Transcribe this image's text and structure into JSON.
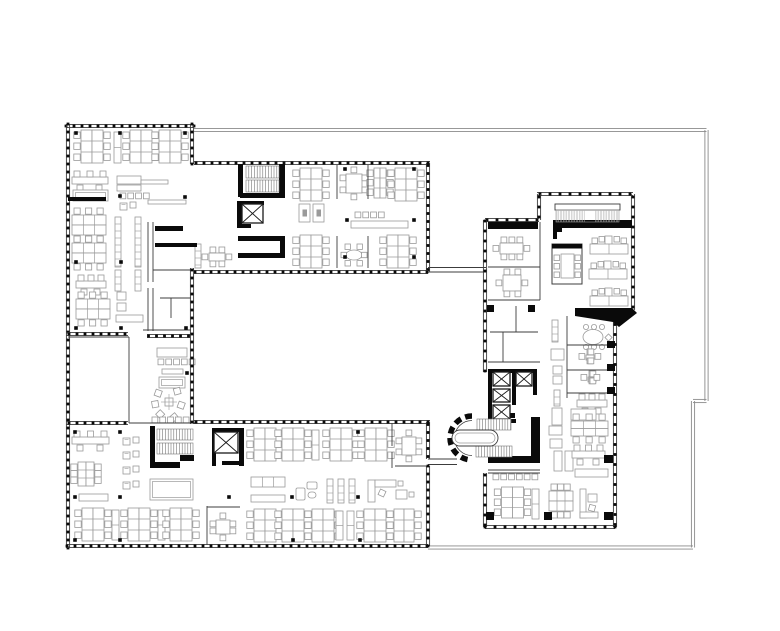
{
  "colors": {
    "bg": "#ffffff",
    "black": "#0a0a0a",
    "wall": "#1a1a1a",
    "thin": "#3c3c3c",
    "light": "#9a9a9a",
    "boundary": "#8a8a8a",
    "tread": "#6a6a6a"
  },
  "canvas": {
    "w": 780,
    "h": 631
  },
  "plan": {
    "boundary": [
      [
        194,
        130,
        706.5,
        130
      ],
      [
        706.5,
        130,
        706.5,
        401
      ],
      [
        693,
        401,
        706.5,
        401
      ],
      [
        693,
        401,
        693,
        547.5
      ],
      [
        428,
        547.5,
        693,
        547.5
      ]
    ],
    "mullion_walls": [
      [
        66,
        126,
        194,
        126
      ],
      [
        68,
        124,
        68,
        548
      ],
      [
        66,
        334,
        128,
        334
      ],
      [
        192,
        124,
        192,
        164
      ],
      [
        194,
        163,
        430,
        163
      ],
      [
        428,
        163,
        428,
        272
      ],
      [
        194,
        272,
        428,
        272
      ],
      [
        192,
        268,
        192,
        424
      ],
      [
        147,
        336,
        190,
        336
      ],
      [
        66,
        423,
        128,
        423
      ],
      [
        194,
        422,
        430,
        422
      ],
      [
        428,
        422,
        428,
        459
      ],
      [
        428,
        466,
        428,
        546
      ],
      [
        66,
        546,
        428,
        546
      ],
      [
        537,
        194,
        633,
        194,
        10
      ],
      [
        633,
        194,
        633,
        310,
        10
      ],
      [
        539,
        194,
        539,
        220,
        10
      ],
      [
        485,
        220,
        539,
        220,
        10
      ],
      [
        485,
        220,
        485,
        372,
        10
      ],
      [
        615,
        322,
        615,
        527,
        10
      ],
      [
        485,
        527,
        615,
        527,
        10
      ],
      [
        485,
        473,
        485,
        527,
        10
      ]
    ],
    "thin_walls": [
      [
        148,
        222,
        148,
        282
      ],
      [
        153,
        222,
        153,
        282
      ],
      [
        148,
        288,
        148,
        331
      ],
      [
        153,
        288,
        153,
        331
      ],
      [
        153,
        270,
        191,
        270
      ],
      [
        160,
        298,
        191,
        298
      ],
      [
        171,
        298,
        171,
        318
      ],
      [
        143,
        330,
        191,
        330
      ],
      [
        337,
        165,
        337,
        199
      ],
      [
        368,
        165,
        368,
        199
      ],
      [
        337,
        236,
        337,
        268
      ],
      [
        368,
        236,
        368,
        268
      ],
      [
        207,
        506,
        207,
        545
      ],
      [
        207,
        507,
        240,
        507
      ],
      [
        392,
        423,
        392,
        446
      ],
      [
        392,
        452,
        392,
        468
      ],
      [
        395,
        466,
        428,
        466
      ],
      [
        129,
        337,
        129,
        423
      ],
      [
        68,
        337,
        129,
        337
      ],
      [
        129,
        423,
        195,
        423
      ],
      [
        428,
        267.5,
        486,
        267.5
      ],
      [
        428,
        272,
        486,
        272
      ],
      [
        428,
        459,
        457,
        459
      ],
      [
        428,
        464.5,
        457,
        464.5
      ],
      [
        540,
        222,
        540,
        300
      ],
      [
        488,
        267,
        540,
        267
      ],
      [
        488,
        300,
        540,
        300
      ],
      [
        516,
        306,
        516,
        332
      ],
      [
        490,
        332,
        538,
        332
      ],
      [
        503,
        332,
        503,
        362
      ],
      [
        488,
        362,
        540,
        362
      ],
      [
        567,
        316,
        567,
        398
      ],
      [
        567,
        345,
        612,
        345
      ],
      [
        567,
        370,
        612,
        370
      ],
      [
        567,
        393,
        612,
        393
      ],
      [
        488,
        470,
        540,
        470
      ],
      [
        488,
        473,
        540,
        473
      ]
    ],
    "black_rects": [
      [
        68,
        197,
        38,
        4
      ],
      [
        238,
        164,
        5,
        33
      ],
      [
        279,
        164,
        6,
        33
      ],
      [
        240,
        193,
        45,
        5
      ],
      [
        237,
        201,
        5,
        27
      ],
      [
        237,
        201,
        27,
        4
      ],
      [
        259,
        207,
        4,
        12
      ],
      [
        237,
        224,
        14,
        4
      ],
      [
        238,
        236,
        46,
        5
      ],
      [
        238,
        253,
        46,
        5
      ],
      [
        280,
        236,
        5,
        22
      ],
      [
        150,
        426,
        5,
        42
      ],
      [
        150,
        462,
        30,
        6
      ],
      [
        180,
        455,
        14,
        6
      ],
      [
        212,
        428,
        4,
        38
      ],
      [
        239,
        428,
        5,
        38
      ],
      [
        212,
        428,
        31,
        4
      ],
      [
        222,
        461,
        22,
        4
      ],
      [
        488,
        222,
        50,
        7
      ],
      [
        553,
        220,
        79,
        8
      ],
      [
        553,
        228,
        9,
        4
      ],
      [
        553,
        228,
        4,
        11
      ],
      [
        488,
        369,
        4,
        53
      ],
      [
        488,
        369,
        48,
        4
      ],
      [
        512,
        372,
        4,
        33
      ],
      [
        533,
        369,
        4,
        26
      ],
      [
        488,
        419,
        28,
        4
      ],
      [
        499,
        413,
        16,
        5
      ],
      [
        488,
        456,
        52,
        7
      ],
      [
        531,
        417,
        9,
        46
      ],
      [
        487,
        305,
        7,
        7
      ],
      [
        528,
        305,
        7,
        7
      ],
      [
        607,
        341,
        8,
        7
      ],
      [
        607,
        364,
        8,
        7
      ],
      [
        607,
        387,
        8,
        7
      ],
      [
        604,
        455,
        9,
        8
      ],
      [
        604,
        512,
        9,
        8
      ],
      [
        544,
        512,
        8,
        8
      ],
      [
        486,
        512,
        8,
        8
      ],
      [
        155,
        226,
        28,
        5
      ],
      [
        155,
        243,
        42,
        4
      ]
    ],
    "black_polys": [
      [
        [
          575,
          308
        ],
        [
          632,
          308
        ],
        [
          637,
          313
        ],
        [
          619,
          327
        ],
        [
          613,
          322
        ],
        [
          575,
          316
        ]
      ]
    ],
    "columns": [
      [
        76,
        133
      ],
      [
        120,
        133
      ],
      [
        185,
        133
      ],
      [
        120,
        196
      ],
      [
        185,
        197
      ],
      [
        76,
        262
      ],
      [
        121,
        262
      ],
      [
        76,
        328
      ],
      [
        121,
        328
      ],
      [
        186,
        328
      ],
      [
        187,
        373
      ],
      [
        345,
        169
      ],
      [
        414,
        169
      ],
      [
        347,
        220
      ],
      [
        414,
        220
      ],
      [
        345,
        257
      ],
      [
        414,
        257
      ],
      [
        75,
        432
      ],
      [
        120,
        432
      ],
      [
        358,
        432
      ],
      [
        75,
        497
      ],
      [
        120,
        497
      ],
      [
        229,
        497
      ],
      [
        292,
        497
      ],
      [
        358,
        497
      ],
      [
        75,
        540
      ],
      [
        120,
        540
      ],
      [
        293,
        540
      ],
      [
        360,
        540
      ]
    ],
    "elevators": [
      [
        242,
        204,
        21,
        19
      ],
      [
        214,
        432,
        24,
        21
      ],
      [
        493,
        372,
        17,
        14
      ],
      [
        516,
        372,
        16,
        14
      ],
      [
        493,
        389,
        17,
        13
      ],
      [
        493,
        405,
        17,
        14
      ]
    ],
    "stairs": [
      [
        246,
        166,
        33,
        12
      ],
      [
        246,
        180,
        33,
        12
      ],
      [
        157,
        429,
        36,
        11
      ],
      [
        157,
        443,
        36,
        11
      ],
      [
        477,
        419,
        34,
        11
      ],
      [
        476,
        446,
        36,
        11
      ]
    ],
    "bump": {
      "cx": 472,
      "cy": 438,
      "r_outer": 22,
      "r_inner": 17.5,
      "island": [
        452,
        430,
        46,
        16
      ]
    },
    "grille": {
      "x": 556,
      "y": 210,
      "w": 63,
      "h": 12,
      "gap_from": 585,
      "gap_to": 595,
      "beam": [
        555,
        204,
        65,
        6
      ]
    },
    "furniture": [
      [
        "bV",
        78,
        130
      ],
      [
        "lk",
        114,
        132,
        31
      ],
      [
        "bV",
        127,
        130
      ],
      [
        "bV",
        156,
        130
      ],
      [
        "dR",
        72,
        172,
        36
      ],
      [
        "cn",
        117,
        176,
        24,
        8
      ],
      [
        "cn",
        141,
        180,
        27,
        4
      ],
      [
        "cn",
        117,
        185,
        24,
        6
      ],
      [
        "cr",
        120,
        193,
        4
      ],
      [
        "sf",
        73,
        190,
        35,
        11
      ],
      [
        "lp",
        120,
        202
      ],
      [
        "cn",
        148,
        200,
        38,
        4
      ],
      [
        "bH",
        72,
        212
      ],
      [
        "bH",
        72,
        240
      ],
      [
        "sh",
        115,
        217,
        50
      ],
      [
        "sh",
        135,
        217,
        50
      ],
      [
        "dR",
        76,
        276,
        30
      ],
      [
        "sh",
        115,
        270,
        21
      ],
      [
        "sh",
        135,
        270,
        21
      ],
      [
        "bH",
        76,
        296
      ],
      [
        "ts",
        117,
        292,
        9,
        8
      ],
      [
        "ts",
        117,
        303,
        9,
        8
      ],
      [
        "cn",
        116,
        315,
        27,
        7
      ],
      [
        "cn",
        157,
        348,
        30,
        9
      ],
      [
        "cr",
        158,
        359,
        5
      ],
      [
        "cn",
        162,
        369,
        21,
        5
      ],
      [
        "sf",
        159,
        377,
        26,
        11
      ],
      [
        "rl",
        152,
        388
      ],
      [
        "cr",
        152,
        417,
        5
      ],
      [
        "mH",
        202,
        247,
        30,
        20
      ],
      [
        "sh",
        195,
        244,
        24
      ],
      [
        "bV",
        297,
        168
      ],
      [
        "mV",
        340,
        167,
        28,
        33
      ],
      [
        "bV",
        371,
        168,
        18,
        30
      ],
      [
        "bV",
        392,
        168
      ],
      [
        "ph",
        299,
        204
      ],
      [
        "ph",
        313,
        204
      ],
      [
        "cr",
        355,
        212,
        4
      ],
      [
        "cn",
        351,
        221,
        57,
        7
      ],
      [
        "bV",
        297,
        235
      ],
      [
        "ov",
        341,
        244,
        26,
        22
      ],
      [
        "bV",
        384,
        235
      ],
      [
        "dR",
        72,
        432,
        37
      ],
      [
        "lp",
        123,
        437
      ],
      [
        "lp",
        123,
        451
      ],
      [
        "lp",
        123,
        466
      ],
      [
        "lp",
        123,
        481
      ],
      [
        "bV",
        75,
        462,
        22,
        24
      ],
      [
        "sf",
        150,
        479,
        43,
        21
      ],
      [
        "cn",
        79,
        494,
        29,
        7
      ],
      [
        "bV",
        79,
        508
      ],
      [
        "lk",
        112,
        510,
        30
      ],
      [
        "bV",
        125,
        508
      ],
      [
        "lk",
        158,
        510,
        30
      ],
      [
        "bV",
        167,
        508
      ],
      [
        "mV",
        210,
        513,
        26,
        28
      ],
      [
        "bV",
        251,
        428
      ],
      [
        "bV",
        279,
        428
      ],
      [
        "lk",
        312,
        430,
        30
      ],
      [
        "bV",
        327,
        428
      ],
      [
        "bV",
        362,
        428
      ],
      [
        "mV",
        396,
        430,
        26,
        32
      ],
      [
        "g6",
        251,
        477,
        34,
        10
      ],
      [
        "cn",
        251,
        495,
        34,
        7
      ],
      [
        "cp",
        296,
        481
      ],
      [
        "sh",
        327,
        479,
        24
      ],
      [
        "sh",
        338,
        479,
        24
      ],
      [
        "sh",
        349,
        479,
        24
      ],
      [
        "ld",
        368,
        478
      ],
      [
        "bV",
        251,
        509
      ],
      [
        "bV",
        279,
        509
      ],
      [
        "bV",
        309,
        509
      ],
      [
        "lk",
        336,
        511,
        29
      ],
      [
        "lk",
        347,
        511,
        29
      ],
      [
        "bV",
        361,
        509
      ],
      [
        "bV",
        391,
        509,
        26,
        33
      ],
      [
        "mH",
        493,
        237,
        37,
        23
      ],
      [
        "mH",
        496,
        269,
        32,
        28
      ],
      [
        "bt",
        552,
        244
      ],
      [
        "lr",
        590,
        237
      ],
      [
        "lr",
        589,
        262
      ],
      [
        "lr",
        590,
        289
      ],
      [
        "sh",
        552,
        320,
        22
      ],
      [
        "ts",
        551,
        349,
        13,
        11
      ],
      [
        "ts",
        553,
        366,
        9,
        8
      ],
      [
        "ts",
        553,
        376,
        9,
        8
      ],
      [
        "sh",
        554,
        390,
        16
      ],
      [
        "ts",
        552,
        408,
        10,
        17
      ],
      [
        "rt",
        581,
        327
      ],
      [
        "mH",
        579,
        349,
        22,
        15
      ],
      [
        "mH",
        581,
        371,
        19,
        13
      ],
      [
        "dR",
        577,
        395,
        30
      ],
      [
        "ts",
        571,
        409,
        25,
        11
      ],
      [
        "cr",
        493,
        474,
        6
      ],
      [
        "bV",
        498,
        487,
        29,
        31
      ],
      [
        "lk",
        532,
        489,
        30
      ],
      [
        "bH",
        549,
        486,
        24,
        30
      ],
      [
        "sl",
        580,
        489
      ],
      [
        "ts",
        549,
        426,
        13,
        9
      ],
      [
        "ts",
        550,
        439,
        12,
        9
      ],
      [
        "t2",
        554,
        451
      ],
      [
        "bH",
        571,
        419,
        37,
        19
      ],
      [
        "dR",
        572,
        446,
        33
      ],
      [
        "cn",
        575,
        469,
        33,
        8
      ]
    ]
  }
}
